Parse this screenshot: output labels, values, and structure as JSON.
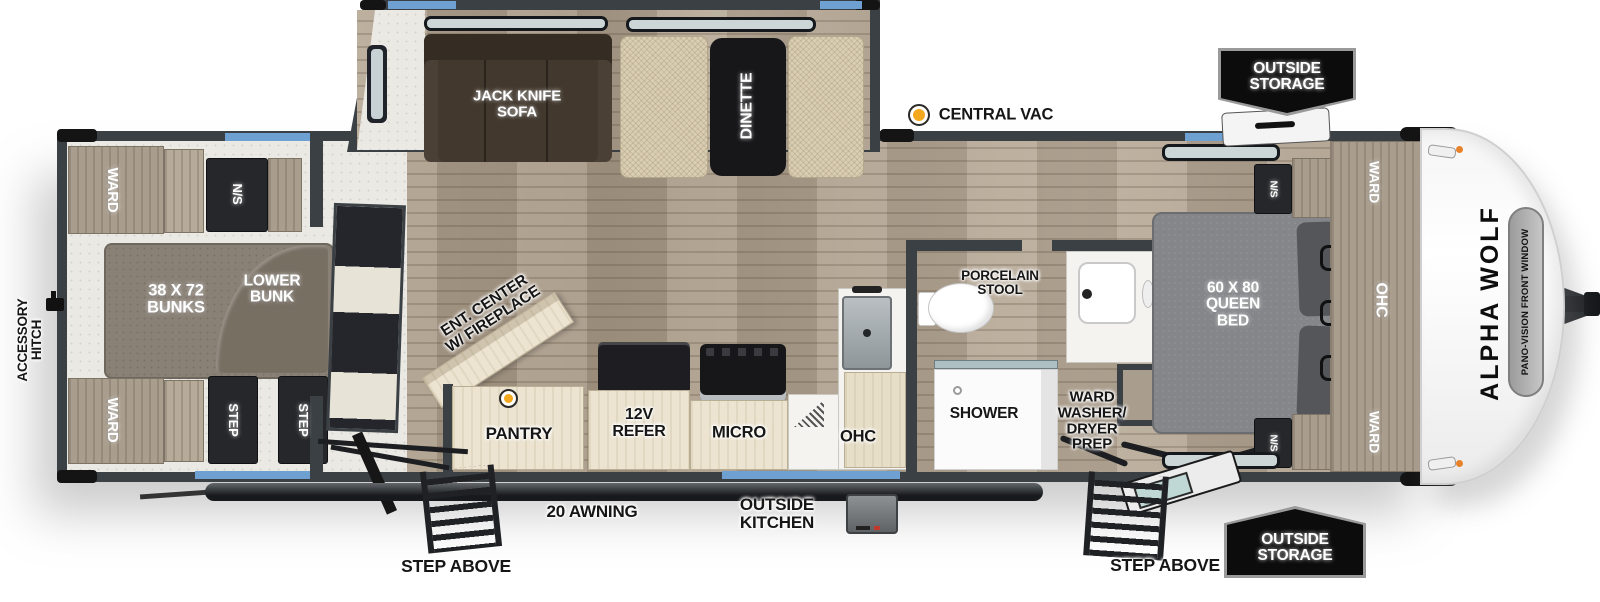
{
  "plan_name": "ALPHA WOLF travel trailer floor plan",
  "slideout": {
    "sofa_label": "JACK KNIFE\nSOFA",
    "dinette_label": "DINETTE"
  },
  "bunk_room": {
    "ward_top": "WARD",
    "ns": "N/S",
    "bunks": "38 X 72\nBUNKS",
    "lower_bunk": "LOWER\nBUNK",
    "ward_bottom": "WARD",
    "step_1": "STEP",
    "step_2": "STEP"
  },
  "living": {
    "ent_center": "ENT. CENTER\nW/ FIREPLACE",
    "pantry": "PANTRY",
    "refer": "12V\nREFER",
    "micro": "MICRO",
    "ohc": "OHC"
  },
  "bathroom": {
    "stool": "PORCELAIN\nSTOOL",
    "shower": "SHOWER",
    "ward_washer_dryer": "WARD\nWASHER/\nDRYER\nPREP"
  },
  "bedroom": {
    "bed": "60 X 80\nQUEEN\nBED",
    "ns_top": "N/S",
    "ns_bottom": "N/S",
    "ward_top": "WARD",
    "ohc": "OHC",
    "ward_bottom": "WARD"
  },
  "exterior": {
    "central_vac": "CENTRAL VAC",
    "outside_storage_top": "OUTSIDE\nSTORAGE",
    "outside_storage_bottom": "OUTSIDE\nSTORAGE",
    "awning": "20 AWNING",
    "outside_kitchen": "OUTSIDE\nKITCHEN",
    "step_above_left": "STEP ABOVE",
    "step_above_right": "STEP ABOVE",
    "accessory_hitch": "ACCESSORY\nHITCH",
    "brand": "ALPHA WOLF",
    "front_window": "PANO-VISION FRONT WINDOW"
  },
  "colors": {
    "wall": "#3b4045",
    "wood_floor": "#b2a492",
    "window_blue": "#6fa0d2",
    "central_vac_dot": "#f3a81e",
    "badge_bg": "#0c0c0c",
    "sofa_brown": "#42382d",
    "bed_gray": "#84868a"
  }
}
